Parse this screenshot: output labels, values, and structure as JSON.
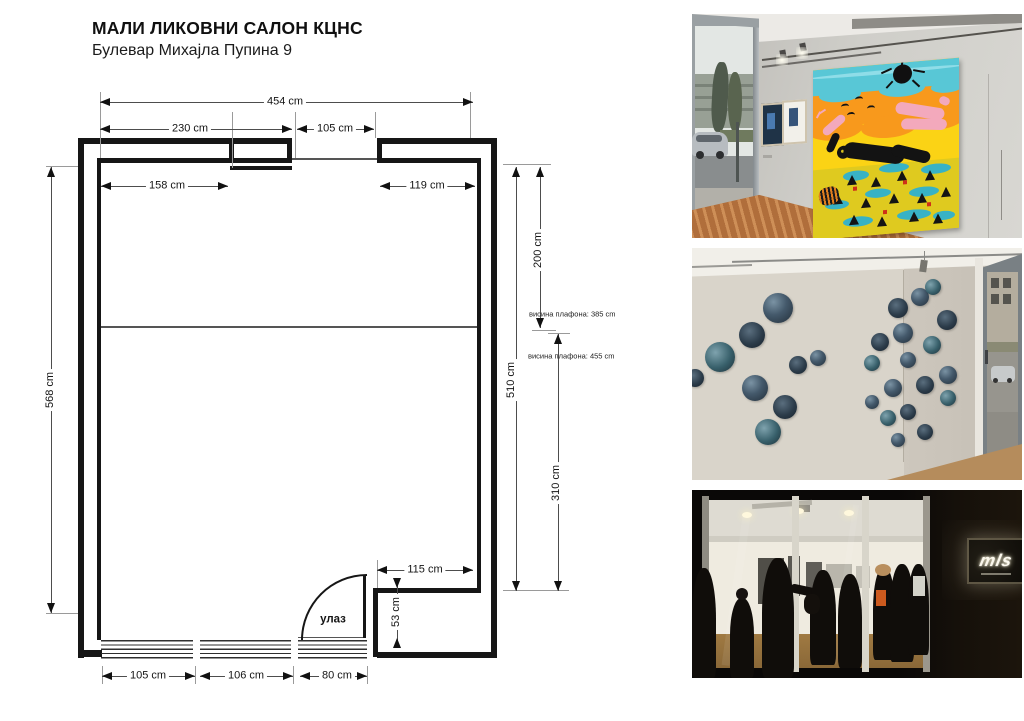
{
  "header": {
    "title": "МАЛИ ЛИКОВНИ САЛОН КЦНС",
    "address": "Булевар Михајла Пупина 9"
  },
  "floor_plan": {
    "entrance_label": "улаз",
    "ceiling_height_note_upper": "висина плафона: 385 cm",
    "ceiling_height_note_lower": "висина плафона: 455 cm",
    "dimensions": {
      "top_total": "454 cm",
      "top_left_segment": "230 cm",
      "top_opening": "105 cm",
      "upper_left_wall": "158 cm",
      "upper_right_wall": "119 cm",
      "left_side_height": "568 cm",
      "right_side_height": "510 cm",
      "right_upper_zone": "200 cm",
      "right_lower_zone": "310 cm",
      "niche_width": "115 cm",
      "niche_depth": "53 cm",
      "bottom_left": "105 cm",
      "bottom_middle": "106 cm",
      "bottom_entrance": "80 cm"
    }
  },
  "photos": {
    "top": {
      "description": "gallery interior with large colorful painting"
    },
    "middle": {
      "description": "gallery corner with circular artworks"
    },
    "bottom": {
      "description": "night view of gallery entrance",
      "sign_text": "mls"
    }
  },
  "colors": {
    "line": "#161616",
    "painting_teal": "#58c7d6",
    "painting_orange": "#f8991c",
    "painting_yellow": "#fbd315",
    "painting_pink": "#f3a9bc",
    "floor_wood": "#b06e3b"
  }
}
